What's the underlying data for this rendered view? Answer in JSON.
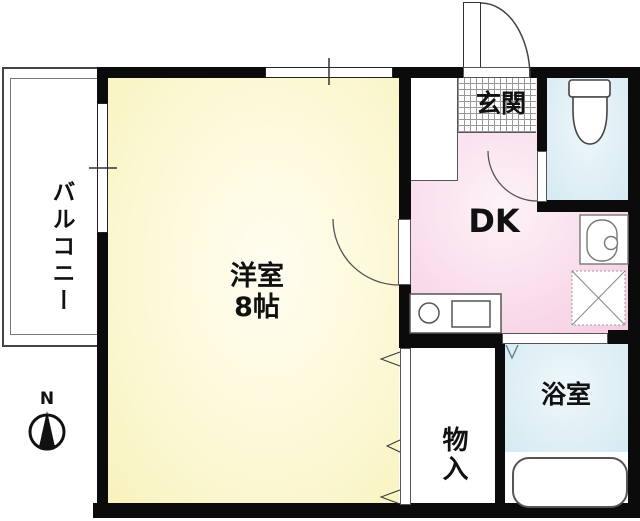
{
  "floorplan": {
    "rooms": {
      "balcony": {
        "label": "バルコニー"
      },
      "western_room": {
        "label": "洋室",
        "size": "8帖"
      },
      "entrance": {
        "label": "玄関"
      },
      "dk": {
        "label": "DK"
      },
      "storage": {
        "label": "物入"
      },
      "bath": {
        "label": "浴室"
      }
    },
    "compass": {
      "north_label": "N"
    },
    "colors": {
      "room_fill": "#F8F2BD",
      "dk_fill": "#F5CCE1",
      "water_fill": "#D5EAF2",
      "wall": "#0B0B0B"
    },
    "icons": {
      "toilet": "toilet-icon",
      "washbasin": "washbasin-icon",
      "washing_machine_pan": "washing-machine-pan-icon",
      "kitchen_counter": "kitchen-counter-icon",
      "bathtub": "bathtub-icon",
      "compass": "compass-north-icon",
      "doors": [
        "entrance-door-swing-icon",
        "toilet-door-swing-icon",
        "room-door-swing-icon",
        "closet-folding-door-icon",
        "bath-door-icon"
      ]
    }
  }
}
